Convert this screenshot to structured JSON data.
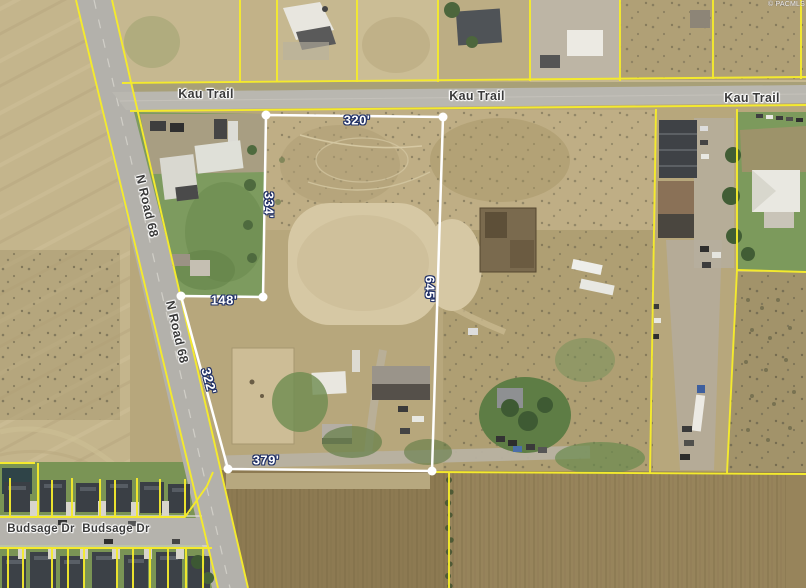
{
  "watermark": "© PACMLS",
  "road_labels": [
    {
      "road": "kau-trail",
      "text": "Kau Trail"
    },
    {
      "road": "kau-trail",
      "text": "Kau Trail"
    },
    {
      "road": "kau-trail",
      "text": "Kau Trail"
    },
    {
      "road": "n-road-68",
      "text": "N Road 68"
    },
    {
      "road": "n-road-68",
      "text": "N Road 68"
    },
    {
      "road": "budsage-dr",
      "text": "Budsage Dr"
    },
    {
      "road": "budsage-dr",
      "text": "Budsage Dr"
    }
  ],
  "subject_parcel": {
    "side_lengths": {
      "north": "320'",
      "west_upper": "334'",
      "jog": "148'",
      "east": "645'",
      "west_lower": "322'",
      "south": "379'"
    }
  },
  "dimension_labels": [
    {
      "side": "north",
      "text": "320'"
    },
    {
      "side": "west-upper",
      "text": "334'"
    },
    {
      "side": "jog",
      "text": "148'"
    },
    {
      "side": "east",
      "text": "645'"
    },
    {
      "side": "west-lower",
      "text": "322'"
    },
    {
      "side": "south",
      "text": "379'"
    }
  ],
  "colors": {
    "parcel_boundary_yellow": "#f4ea2d",
    "subject_boundary_white": "#ffffff",
    "dimension_text": "#ffffff",
    "dimension_halo": "#203066",
    "road_label_text": "#3a3a3a",
    "road_label_halo": "#ffffff"
  }
}
